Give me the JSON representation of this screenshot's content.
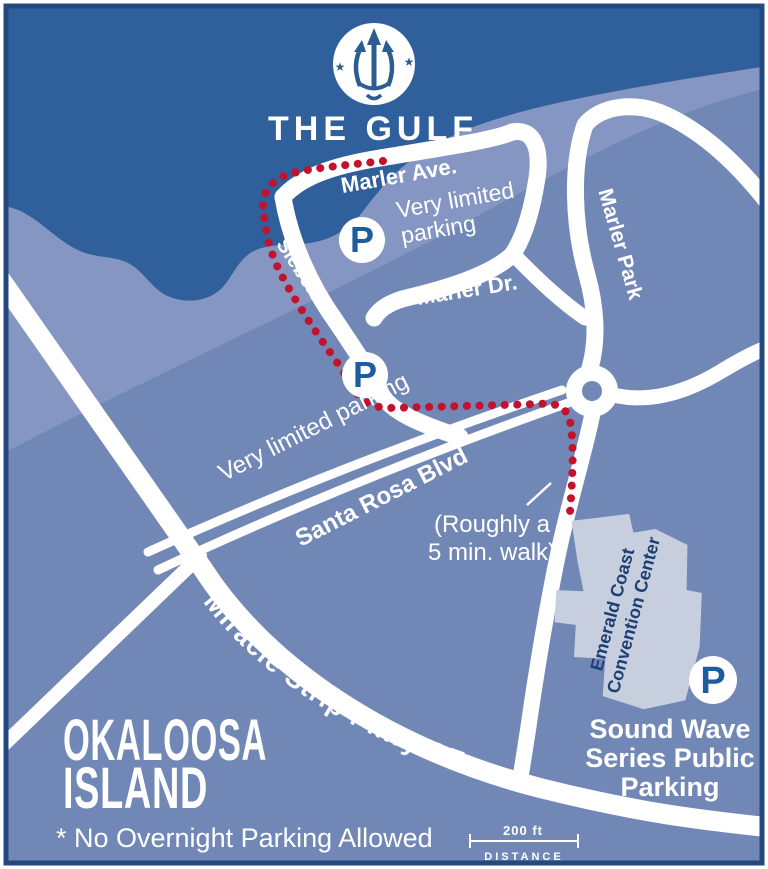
{
  "map": {
    "logo": {
      "title": "THE GULF",
      "icon": "trident-icon"
    },
    "roads": {
      "marler_ave": "Marler Ave.",
      "marler_dr": "Marler Dr.",
      "siebert_dr": "Siebert Dr.",
      "marler_park": "Marler Park",
      "santa_rosa_blvd": "Santa Rosa Blvd",
      "miracle_strip": "Miracle Strip Pkwy SE"
    },
    "notes": {
      "very_limited_top_line1": "Very limited",
      "very_limited_top_line2": "parking",
      "very_limited_bottom": "Very limited parking",
      "walk_line1": "(Roughly a",
      "walk_line2": "5 min. walk)",
      "no_overnight": "* No Overnight Parking Allowed"
    },
    "places": {
      "island_line1": "OKALOOSA",
      "island_line2": "ISLAND",
      "convention_line1": "Emerald Coast",
      "convention_line2": "Convention Center",
      "sound_wave_line1": "Sound Wave",
      "sound_wave_line2": "Series Public",
      "sound_wave_line3": "Parking"
    },
    "parking_symbol": "P",
    "scale_bar": {
      "distance_label": "200 ft",
      "caption": "DISTANCE"
    },
    "colors": {
      "water": "#30609c",
      "land": "#7187b6",
      "shore_band": "#8496c1",
      "road": "#ffffff",
      "route_dots": "#c3122d",
      "building": "#c7cfdf",
      "navy_text": "#1e3f74",
      "parking_blue": "#1d5c9e",
      "border": "#24497e"
    }
  }
}
